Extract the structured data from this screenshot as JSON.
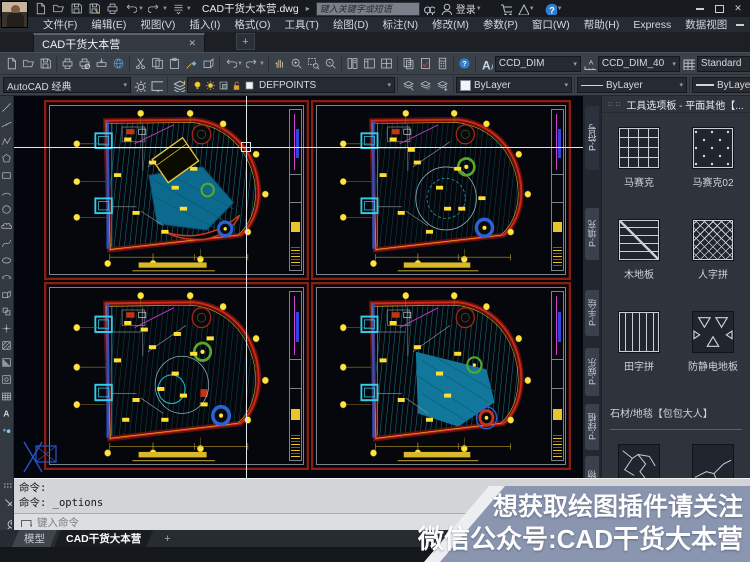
{
  "titlebar": {
    "doc_title": "CAD干货大本营.dwg",
    "search_placeholder": "键入关键字或短语",
    "login_label": "登录",
    "qat_icons": [
      "new",
      "open",
      "save",
      "save-as",
      "plot",
      "undo",
      "redo",
      "customize"
    ],
    "right_icons": [
      "search-exchange",
      "user",
      "cart",
      "autodesk-a",
      "help"
    ]
  },
  "menubar": {
    "items": [
      "文件(F)",
      "编辑(E)",
      "视图(V)",
      "插入(I)",
      "格式(O)",
      "工具(T)",
      "绘图(D)",
      "标注(N)",
      "修改(M)",
      "参数(P)",
      "窗口(W)",
      "帮助(H)",
      "Express",
      "数据视图"
    ]
  },
  "doc_tabs": {
    "active": "CAD干货大本营",
    "close": "✕",
    "add": "+"
  },
  "toolbars": {
    "standard_groups": [
      [
        "new",
        "open",
        "save"
      ],
      [
        "plot",
        "preview",
        "publish",
        "globe"
      ],
      [
        "cut",
        "copy",
        "paste",
        "matchprop",
        "blockedit"
      ],
      [
        "undo",
        "redo"
      ],
      [
        "pan",
        "zoom-rt",
        "zoom-win",
        "zoom-prev"
      ],
      [
        "props",
        "designcenter",
        "toolpalettes"
      ],
      [
        "sheetset",
        "markup",
        "quickcalc"
      ],
      [
        "help"
      ]
    ],
    "text_style": "CCD_DIM",
    "dim_style": "CCD_DIM_40",
    "table_style": "Standard",
    "workspace": "AutoCAD 经典",
    "layer_current": "DEFPOINTS",
    "layer_state_icons": [
      "bulb",
      "sun",
      "locktrans",
      "lockopen",
      "swatch-white"
    ],
    "layer_tool_icons": [
      "layer-make",
      "layer-match",
      "layer-prev"
    ],
    "color": "ByLayer",
    "linetype": "ByLayer",
    "lineweight": "ByLayer"
  },
  "draw_toolbar_icons": [
    "line",
    "xline",
    "pline",
    "polygon",
    "rectangle",
    "arc",
    "circle",
    "revcloud",
    "spline",
    "ellipse",
    "ellipse-arc",
    "insert-block",
    "make-block",
    "point",
    "hatch",
    "gradient",
    "region",
    "table",
    "mtext",
    "osnap-dots"
  ],
  "viewports": [
    {
      "name": "furniture-plan",
      "variant": "pool"
    },
    {
      "name": "ceiling-plan",
      "variant": "circles"
    },
    {
      "name": "electrical-plan",
      "variant": "detail"
    },
    {
      "name": "floor-finish-plan",
      "variant": "blob"
    }
  ],
  "palette": {
    "title": "工具选项板 - 平面其他【...",
    "side_tabs": [
      "P-符号",
      "P-填充",
      "P-手绘",
      "P-娱乐",
      "P-绿植",
      "人物"
    ],
    "items": [
      {
        "label": "马赛克",
        "pattern": "grid"
      },
      {
        "label": "马赛克02",
        "pattern": "dots"
      },
      {
        "label": "木地板",
        "pattern": "planks"
      },
      {
        "label": "人字拼",
        "pattern": "herringbone"
      },
      {
        "label": "田字拼",
        "pattern": "vlines"
      },
      {
        "label": "防静电地板",
        "pattern": "triangles"
      }
    ],
    "section_label": "石材/地毯【包包大人】",
    "partial_items": [
      {
        "pattern": "crack1"
      },
      {
        "pattern": "crack2"
      }
    ]
  },
  "command": {
    "history": [
      "命令:",
      "命令: _options"
    ],
    "input_placeholder": "键入命令"
  },
  "layout_tabs": {
    "model": "模型",
    "layout": "CAD干货大本营",
    "add": "+"
  },
  "banner": {
    "line1": "想获取绘图插件请关注",
    "line2": "微信公众号:CAD干货大本营",
    "bg_color": "#8a96b0"
  },
  "colors": {
    "canvas_bg": "#03060c",
    "sheet_border": "#8c1d12",
    "hatch_teal": "#14808f",
    "marker_yellow": "#ffe33e",
    "wall_red": "#cf2a18",
    "accent_cyan": "#35cde8",
    "pool_blue": "#0d6a8f"
  }
}
